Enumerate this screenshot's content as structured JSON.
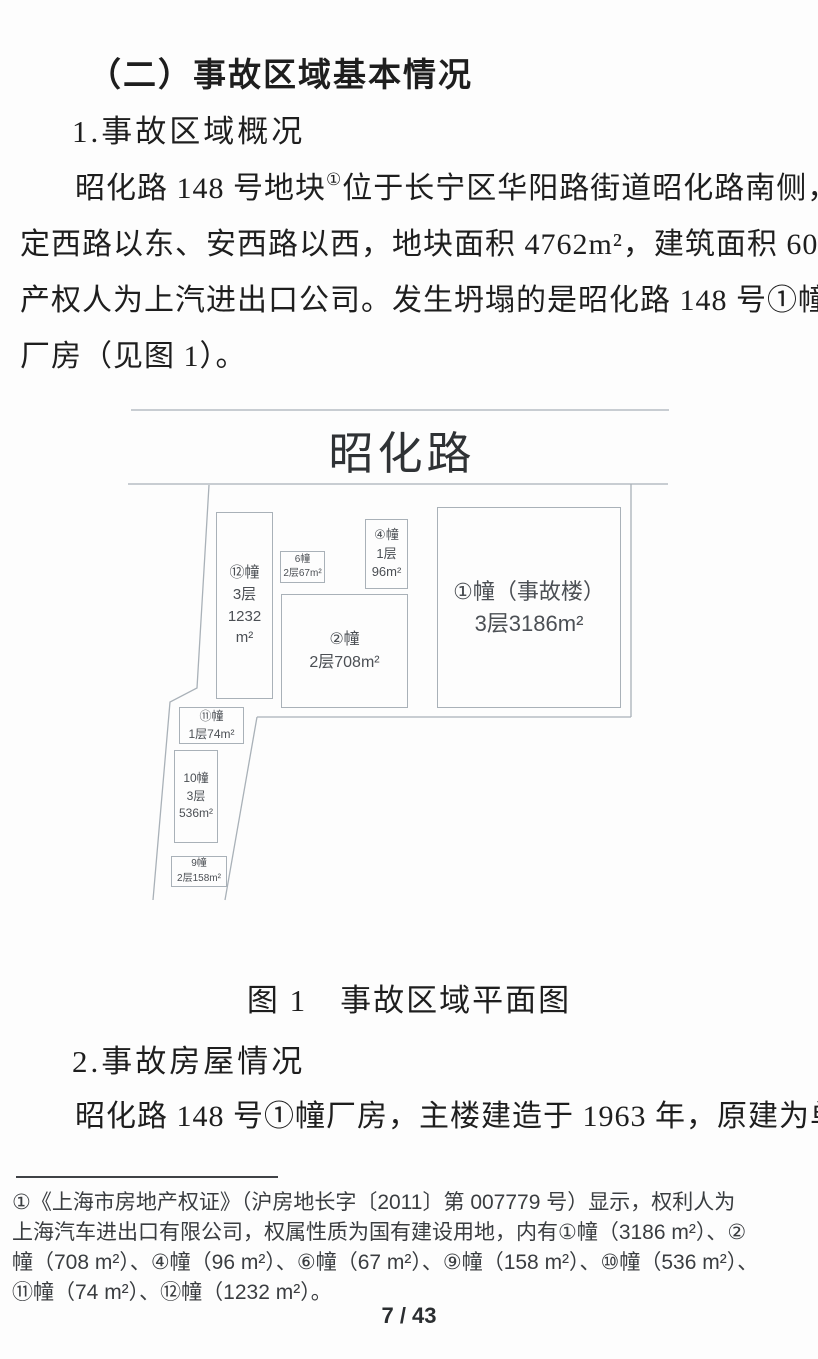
{
  "page": {
    "heading": "（二）事故区域基本情况",
    "section1_title": "1.事故区域概况",
    "para1": {
      "l1_pre": "昭化路 148 号地块",
      "l1_sup": "①",
      "l1_post": "位于长宁区华阳路街道昭化路南侧，",
      "l2": "定西路以东、安西路以西，地块面积 4762m²，建筑面积 6057m²。",
      "l3": "产权人为上汽进出口公司。发生坍塌的是昭化路 148 号①幢",
      "l4": "厂房（见图 1）。"
    },
    "figure": {
      "road_name": "昭化路",
      "caption": "图 1　事故区域平面图",
      "buildings": [
        {
          "id": "building-1",
          "label": "①幢（事故楼）\n3层3186m²"
        },
        {
          "id": "building-2",
          "label": "②幢\n2层708m²"
        },
        {
          "id": "building-4",
          "label": "④幢\n1层\n96m²"
        },
        {
          "id": "building-6",
          "label": "6幢\n2层67m²"
        },
        {
          "id": "building-9",
          "label": "9幢\n2层158m²"
        },
        {
          "id": "building-10",
          "label": "10幢\n3层\n536m²"
        },
        {
          "id": "building-11",
          "label": "⑪幢\n1层74m²"
        },
        {
          "id": "building-12",
          "label": "⑫幢\n3层\n1232\nm²"
        }
      ]
    },
    "section2_title": "2.事故房屋情况",
    "para2": {
      "l1": "昭化路 148 号①幢厂房，主楼建造于 1963 年，原建为单"
    },
    "footnote": {
      "l1": "①《上海市房地产权证》（沪房地长字〔2011〕第 007779 号）显示，权利人为",
      "l2": "上海汽车进出口有限公司，权属性质为国有建设用地，内有①幢（3186 m²）、②",
      "l3": "幢（708 m²）、④幢（96 m²）、⑥幢（67 m²）、⑨幢（158 m²）、⑩幢（536 m²）、",
      "l4": "⑪幢（74 m²）、⑫幢（1232 m²）。"
    },
    "page_number": "7 / 43"
  },
  "colors": {
    "page_background": "#fdfdfd",
    "body_text": "#1e1e1e",
    "diagram_line": "#a9b1b8",
    "diagram_text": "#4b4f54",
    "footnote_rule": "#3f4246"
  }
}
